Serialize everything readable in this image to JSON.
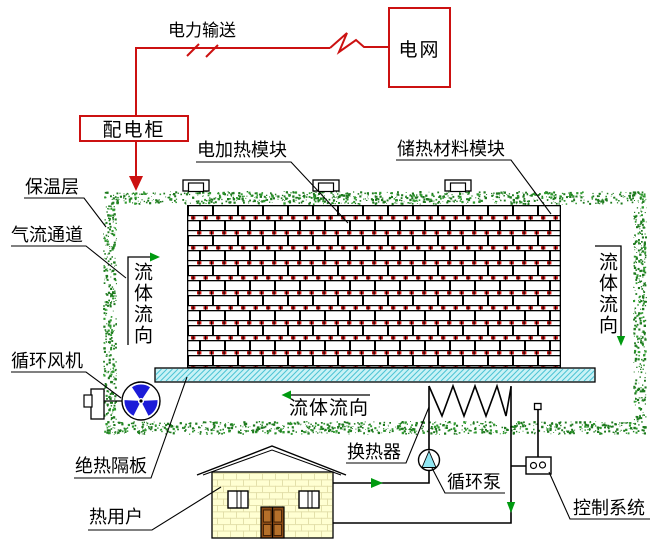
{
  "diagram": {
    "type": "schematic",
    "subject": "electric thermal-storage heating system",
    "labels": {
      "power_transmission": "电力输送",
      "power_grid": "电网",
      "distribution_cabinet": "配电柜",
      "electric_heating_module": "电加热模块",
      "storage_material_module": "储热材料模块",
      "insulation_layer": "保温层",
      "airflow_channel": "气流通道",
      "circulation_fan": "循环风机",
      "adiabatic_partition": "绝热隔板",
      "heat_user": "热用户",
      "heat_exchanger": "换热器",
      "circulation_pump": "循环泵",
      "control_system": "控制系统",
      "fluid_flow": "流体流向"
    },
    "colors": {
      "accent_red": "#cc1111",
      "flow_arrow_green": "#009a10",
      "insulation_speckle_green": "#1e7a1e",
      "platform_cyan": "#c9f2f6",
      "platform_hatch": "#4cc3d4",
      "fan_blue": "#1c1cd8",
      "pump_triangle_cyan": "#90e6f2",
      "house_wall_yellow": "#ffffd2",
      "door_brown": "#8a4a15",
      "heater_red": "#cc1111"
    }
  }
}
